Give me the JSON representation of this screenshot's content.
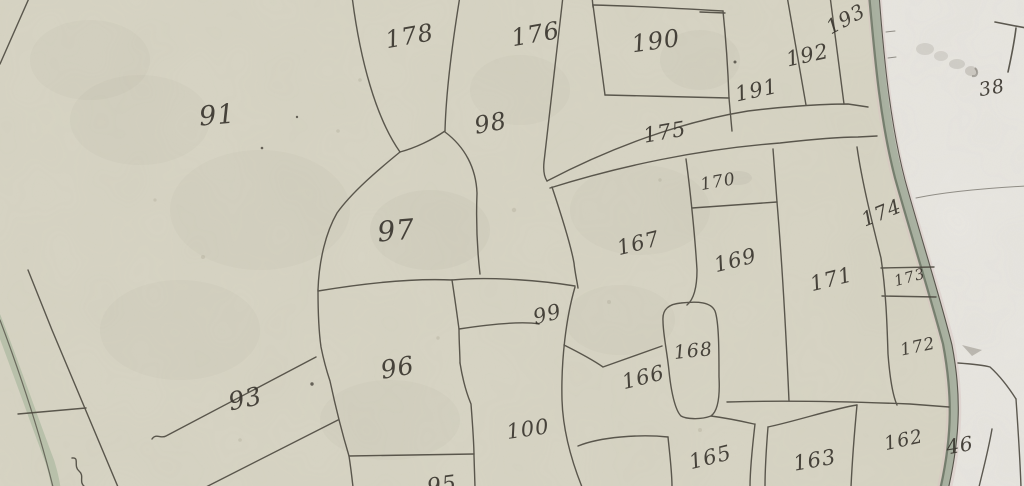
{
  "map": {
    "description": "historical hand-drawn parcel map",
    "colors": {
      "paper_left": "#d8d5c5",
      "paper_right": "#e9e7e2",
      "ink": "#49453c",
      "label_ink": "#3a362f",
      "river_green": "#a3ad9b",
      "river_dark": "#667060",
      "river_pink": "#d8c3c1",
      "road_green": "#b3bda6"
    },
    "parcels": [
      {
        "number": "91",
        "x": 218,
        "y": 124,
        "size": 27,
        "rot": -5
      },
      {
        "number": "178",
        "x": 411,
        "y": 44,
        "size": 24,
        "rot": -10
      },
      {
        "number": "176",
        "x": 537,
        "y": 42,
        "size": 24,
        "rot": -10
      },
      {
        "number": "98",
        "x": 492,
        "y": 131,
        "size": 24,
        "rot": -10
      },
      {
        "number": "190",
        "x": 657,
        "y": 49,
        "size": 24,
        "rot": -8
      },
      {
        "number": "191",
        "x": 758,
        "y": 97,
        "size": 21,
        "rot": -12
      },
      {
        "number": "192",
        "x": 809,
        "y": 62,
        "size": 21,
        "rot": -12
      },
      {
        "number": "193",
        "x": 849,
        "y": 25,
        "size": 20,
        "rot": -28
      },
      {
        "number": "175",
        "x": 666,
        "y": 139,
        "size": 21,
        "rot": -10
      },
      {
        "number": "170",
        "x": 719,
        "y": 187,
        "size": 17,
        "rot": -10
      },
      {
        "number": "167",
        "x": 640,
        "y": 250,
        "size": 21,
        "rot": -14
      },
      {
        "number": "169",
        "x": 737,
        "y": 267,
        "size": 21,
        "rot": -14
      },
      {
        "number": "171",
        "x": 833,
        "y": 286,
        "size": 21,
        "rot": -14
      },
      {
        "number": "174",
        "x": 884,
        "y": 219,
        "size": 20,
        "rot": -22
      },
      {
        "number": "173",
        "x": 911,
        "y": 282,
        "size": 15,
        "rot": -15
      },
      {
        "number": "172",
        "x": 919,
        "y": 352,
        "size": 17,
        "rot": -12
      },
      {
        "number": "97",
        "x": 397,
        "y": 240,
        "size": 28,
        "rot": -5
      },
      {
        "number": "99",
        "x": 549,
        "y": 321,
        "size": 21,
        "rot": -14
      },
      {
        "number": "96",
        "x": 399,
        "y": 376,
        "size": 25,
        "rot": -10
      },
      {
        "number": "93",
        "x": 247,
        "y": 407,
        "size": 25,
        "rot": -12
      },
      {
        "number": "100",
        "x": 529,
        "y": 436,
        "size": 21,
        "rot": -8
      },
      {
        "number": "166",
        "x": 645,
        "y": 384,
        "size": 21,
        "rot": -14
      },
      {
        "number": "168",
        "x": 694,
        "y": 357,
        "size": 19,
        "rot": -6
      },
      {
        "number": "165",
        "x": 712,
        "y": 464,
        "size": 21,
        "rot": -14
      },
      {
        "number": "163",
        "x": 816,
        "y": 467,
        "size": 21,
        "rot": -10
      },
      {
        "number": "162",
        "x": 905,
        "y": 446,
        "size": 19,
        "rot": -12
      },
      {
        "number": "46",
        "x": 961,
        "y": 452,
        "size": 20,
        "rot": -10
      },
      {
        "number": "38",
        "x": 993,
        "y": 94,
        "size": 19,
        "rot": -10
      },
      {
        "number": "95",
        "x": 443,
        "y": 492,
        "size": 22,
        "rot": -8
      }
    ]
  }
}
